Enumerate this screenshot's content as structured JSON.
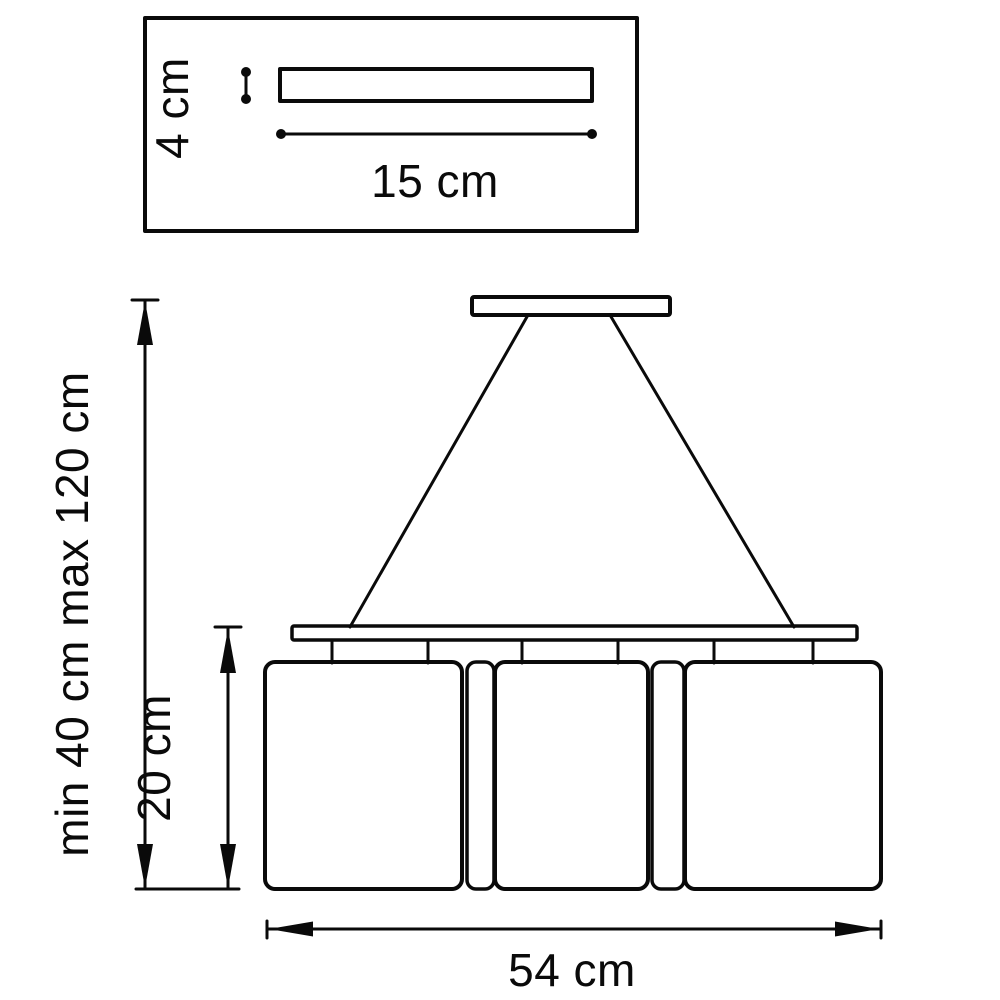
{
  "detail_view": {
    "height_label": "4 cm",
    "width_label": "15 cm"
  },
  "main_view": {
    "overall_height_label": "min 40 cm max 120 cm",
    "shade_height_label": "20 cm",
    "overall_width_label": "54 cm"
  },
  "colors": {
    "line": "#0a0a0a",
    "background": "#ffffff"
  }
}
